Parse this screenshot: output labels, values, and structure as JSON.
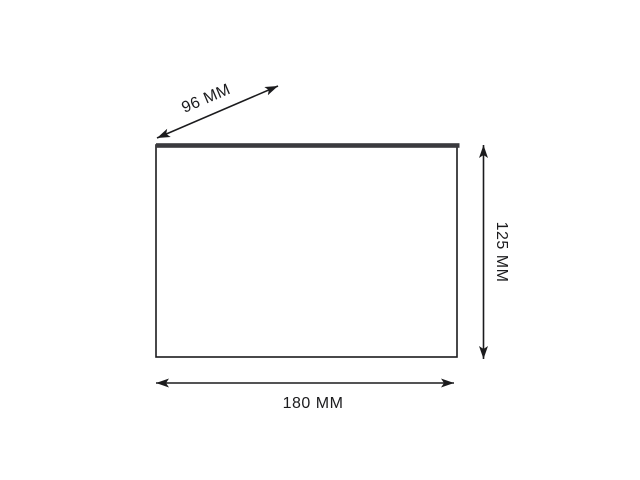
{
  "diagram": {
    "type": "product-dimension-drawing",
    "shape": "rectangular-panel",
    "dimension_labels": {
      "depth": "96 MM",
      "height": "125 MM",
      "width": "180 MM"
    },
    "dimension_values": {
      "depth_mm": 96,
      "height_mm": 125,
      "width_mm": 180,
      "unit": "MM"
    },
    "colors": {
      "line": "#1b1b1d",
      "text": "#1c1c1e",
      "panel_top_edge": "#3a3a3e",
      "panel_fill": "#ffffff",
      "background": "#ffffff"
    }
  }
}
